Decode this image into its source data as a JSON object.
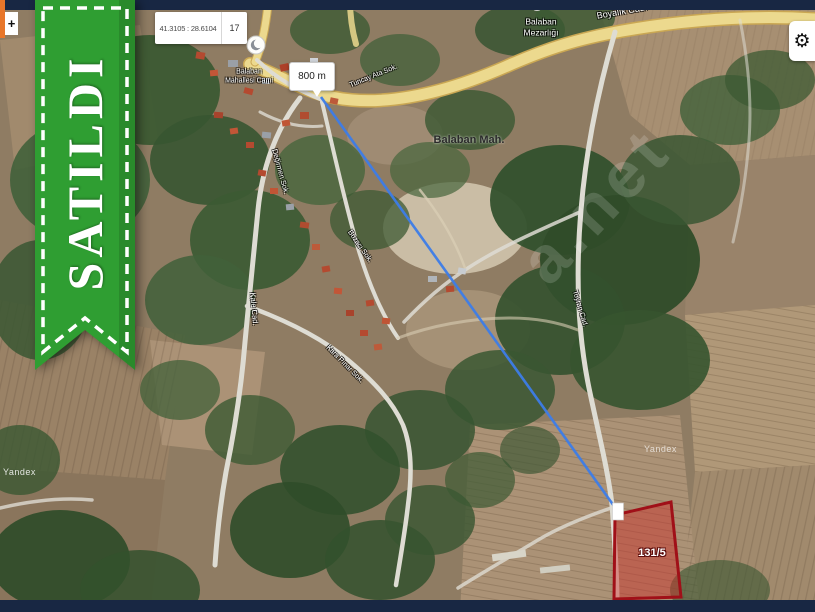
{
  "map_controls": {
    "coordinates": "41.3105 : 28.6104",
    "zoom_level": "17",
    "zoom_in_label": "+",
    "settings_icon": "⚙"
  },
  "ribbon": {
    "label": "SATILDI",
    "color": "#2f9e32"
  },
  "distance_marker": {
    "label": "800 m"
  },
  "parcel": {
    "label": "131/5",
    "outline_color": "#a01018"
  },
  "places": {
    "mosque_line1": "Balaban",
    "mosque_line2": "Mahallesi Cami",
    "cemetery_line1": "Balaban",
    "cemetery_line2": "Mezarlığı",
    "district": "Balaban Mah."
  },
  "roads": [
    {
      "label": "Boyalık Cad."
    },
    {
      "label": "Tuncay Ata Sok."
    },
    {
      "label": "Değirmen Sok."
    },
    {
      "label": "Bozacı Sok."
    },
    {
      "label": "Kale Cad."
    },
    {
      "label": "Kara Pınar Sok."
    },
    {
      "label": "Toyran Cad."
    }
  ],
  "watermarks": {
    "provider": "Yandex",
    "site_fragment": "a.net"
  },
  "colors": {
    "route_blue": "#3d7de8",
    "top_bar": "#182743"
  }
}
